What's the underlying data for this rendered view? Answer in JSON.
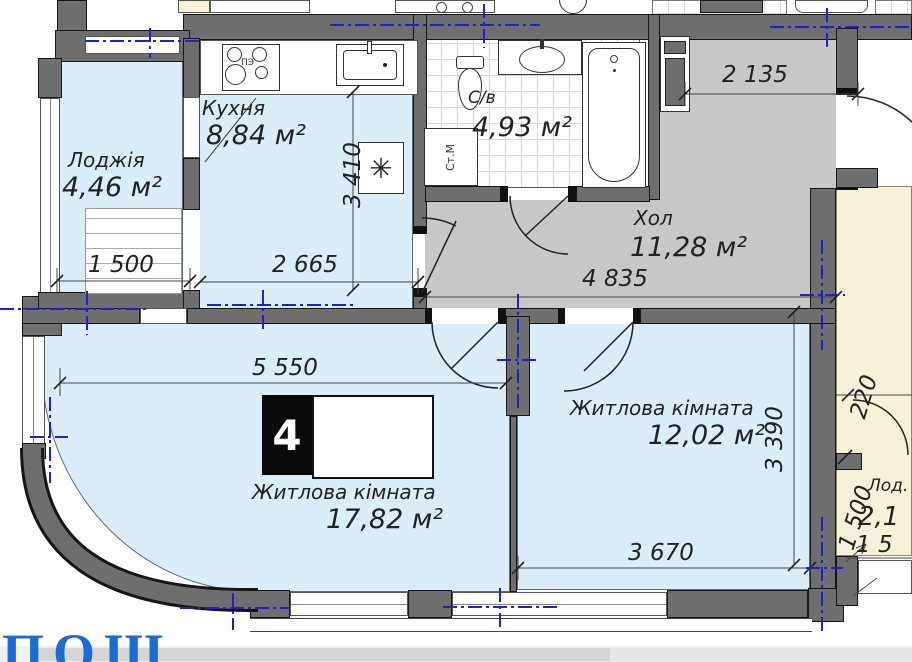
{
  "rooms": {
    "loggia": {
      "name": "Лоджія",
      "area": "4,46 м²"
    },
    "kitchen": {
      "name": "Кухня",
      "area": "8,84 м²"
    },
    "bathroom": {
      "name": "С/в",
      "area": "4,93 м²"
    },
    "hall": {
      "name": "Хол",
      "area": "11,28 м²"
    },
    "living1": {
      "name": "Житлова кімната",
      "area": "17,82 м²"
    },
    "living2": {
      "name": "Житлова кімната",
      "area": "12,02 м²"
    },
    "neighbor": {
      "name": "Лод.",
      "area": "2,1"
    }
  },
  "dims": {
    "loggia_w": "1 500",
    "kitchen_w": "2 665",
    "kitchen_h": "3 410",
    "hall_entry": "2 135",
    "hall_w": "4 835",
    "living1_w": "5 550",
    "living2_h": "3 390",
    "living2_w": "3 670",
    "neighbor_a": "220",
    "neighbor_b": "1 500",
    "neighbor_c": "1 5"
  },
  "fixtures": {
    "stove_label": "ПЭ",
    "washer_label": "Ст.М",
    "vent_symbol": "✳"
  },
  "badge_number": "4",
  "watermark": "ПОШ",
  "colors": {
    "room_fill": "#dbedf8",
    "hall_fill": "#c8c8c8",
    "wall": "#6e6e6e",
    "neighbor_fill": "#f6f1d8",
    "axis": "#2121cc",
    "watermark": "#1c6bd2"
  }
}
